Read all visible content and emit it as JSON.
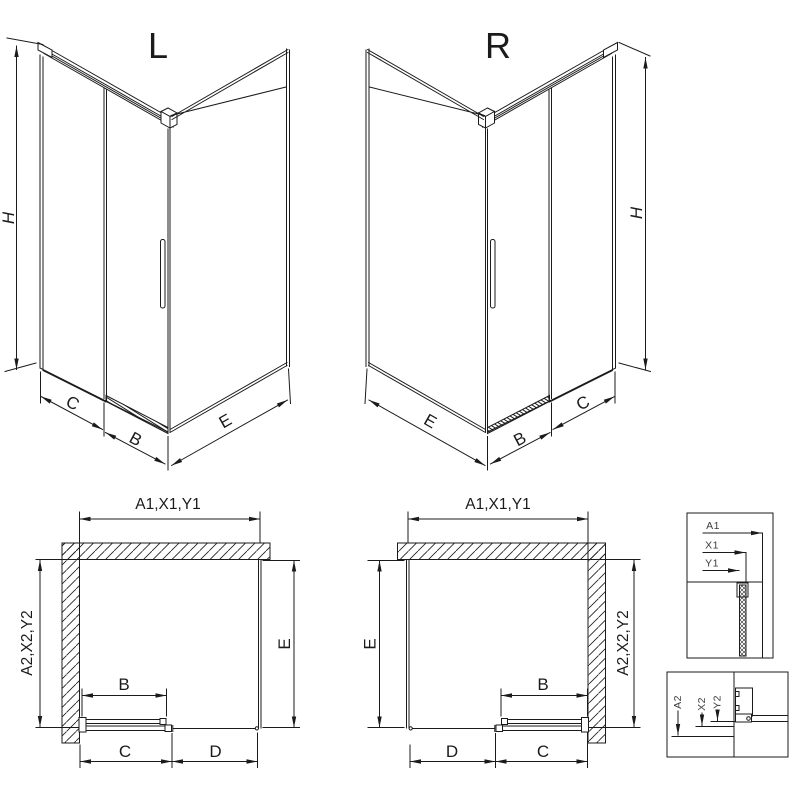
{
  "drawing": {
    "colors": {
      "line": "#1b1b1b",
      "background": "#ffffff"
    },
    "iso_left": {
      "title": "L",
      "dim_height": "H",
      "dim_front_fixed": "C",
      "dim_door": "B",
      "dim_side": "E"
    },
    "iso_right": {
      "title": "R",
      "dim_height": "H",
      "dim_front_fixed": "C",
      "dim_door": "B",
      "dim_side": "E"
    },
    "plan_left": {
      "dim_top": "A1,X1,Y1",
      "dim_left_vertical": "A2,X2,Y2",
      "dim_depth": "E",
      "dim_door": "B",
      "dim_bottom_first": "C",
      "dim_bottom_second": "D"
    },
    "plan_right": {
      "dim_top": "A1,X1,Y1",
      "dim_right_vertical": "A2,X2,Y2",
      "dim_depth": "E",
      "dim_door": "B",
      "dim_bottom_first": "D",
      "dim_bottom_second": "C"
    },
    "detail_wall_section": {
      "label_1": "A1",
      "label_2": "X1",
      "label_3": "Y1"
    },
    "detail_floor_section": {
      "label_1": "A2",
      "label_2": "X2",
      "label_3": "Y2"
    }
  }
}
